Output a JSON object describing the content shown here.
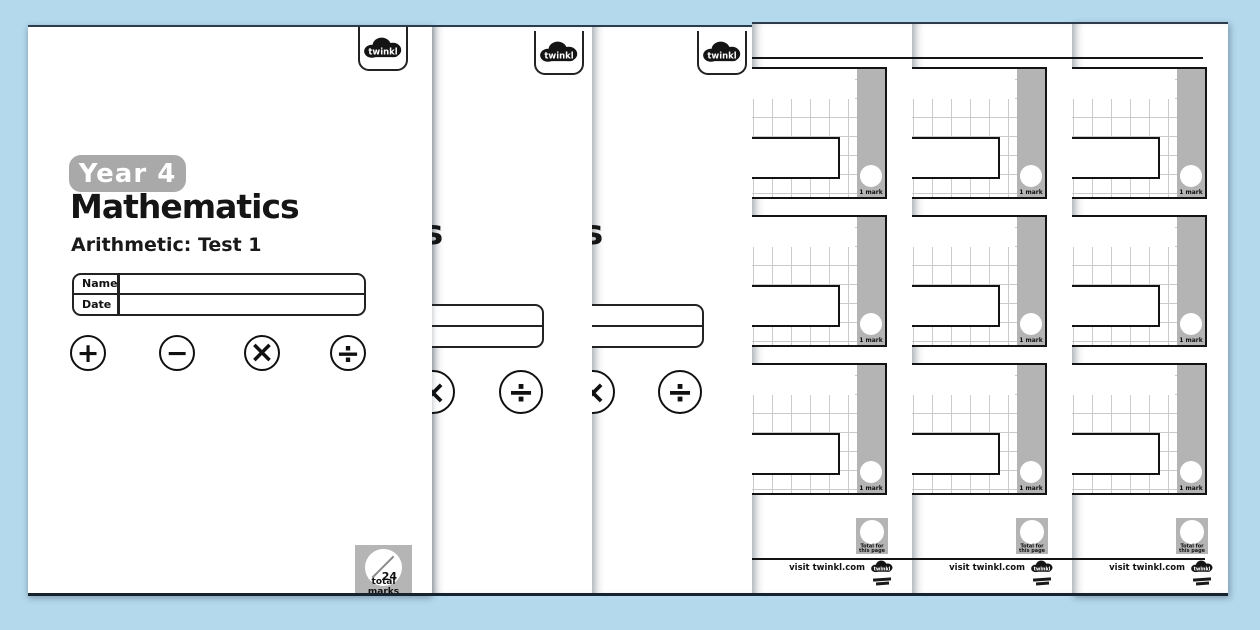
{
  "app": {
    "background_color": "#b4d8ec"
  },
  "brand": {
    "logo_text": "twinkl"
  },
  "cover": {
    "year_badge": "Year 4",
    "title": "Mathematics",
    "title_tail": "s",
    "subtitle": "Arithmetic: Test 1",
    "fields": {
      "name_label": "Name",
      "date_label": "Date"
    },
    "operations": [
      "+",
      "−",
      "×",
      "÷"
    ],
    "total_marks": {
      "value": "24",
      "label": "total marks"
    }
  },
  "worksheet": {
    "questions": [
      {
        "mark": "1 mark"
      },
      {
        "mark": "1 mark"
      },
      {
        "mark": "1 mark"
      }
    ],
    "total_badge": {
      "line1": "Total for",
      "line2": "this page"
    },
    "footer_text": "visit twinkl.com"
  },
  "colors": {
    "page": "#ffffff",
    "badge_gray": "#a9a9a9",
    "bar_gray": "#b4b4b4",
    "grid_line": "#cbcbcb",
    "ink": "#141414"
  }
}
